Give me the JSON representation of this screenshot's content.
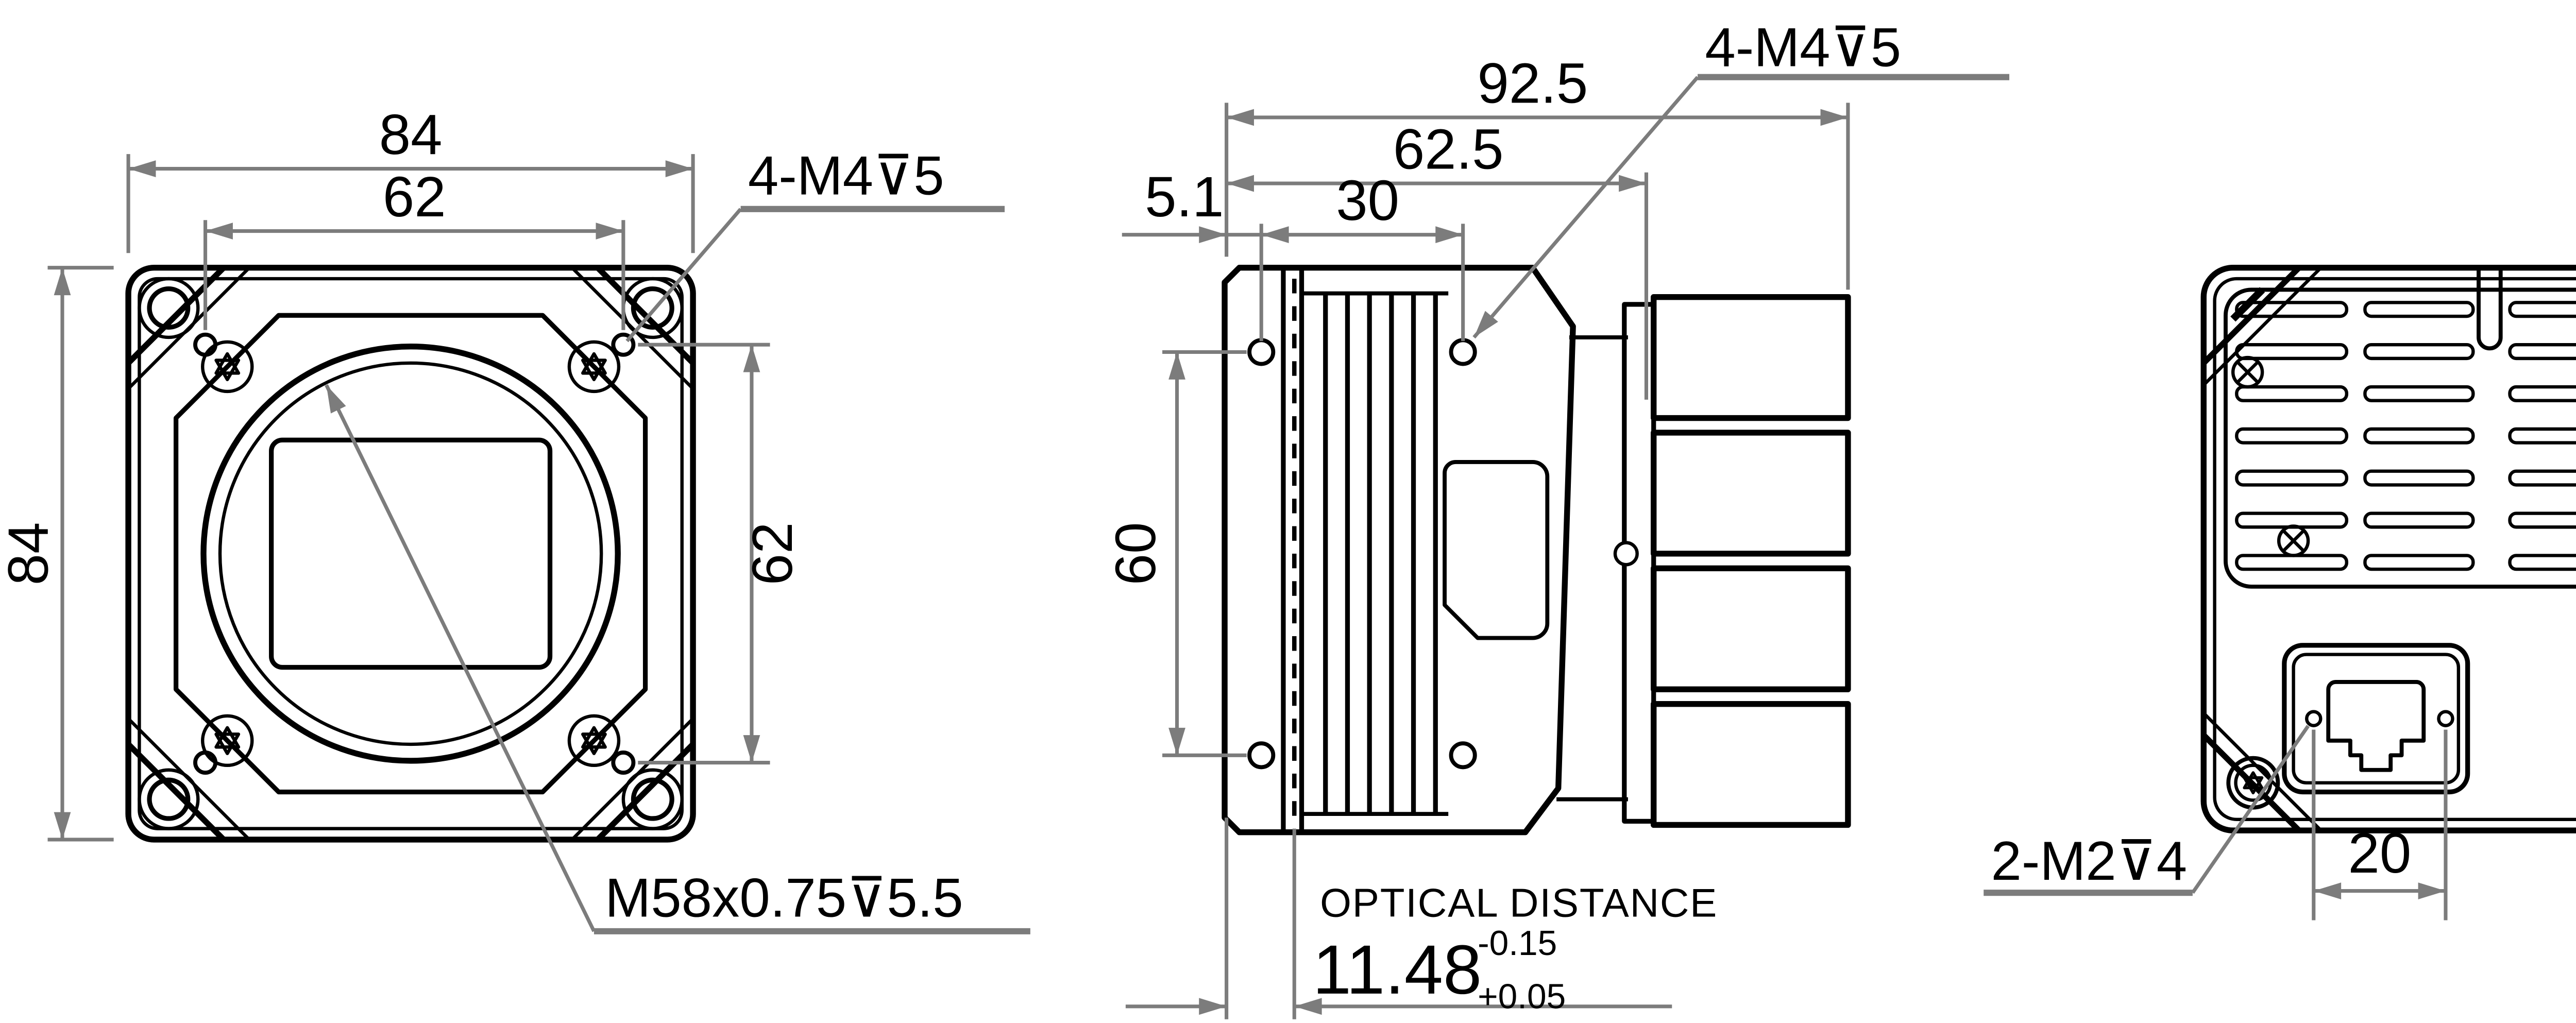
{
  "unit_label": "Unit: mm",
  "front_view": {
    "dim_width": "84",
    "dim_width_inner": "62",
    "dim_height": "84",
    "dim_height_inner": "62",
    "thread_label": "4-M4⊽5",
    "mount_label": "M58x0.75⊽5.5"
  },
  "side_view": {
    "dim_total": "92.5",
    "dim_body": "62.5",
    "dim_flange": "5.1",
    "dim_hole_offset": "30",
    "dim_hole_spacing": "60",
    "thread_label": "4-M4⊽5",
    "optical_distance_label": "OPTICAL DISTANCE",
    "optical_distance_value": "11.48",
    "tolerance_upper": "-0.15",
    "tolerance_lower": "+0.05"
  },
  "rear_view": {
    "thread_label": "2-M2⊽4",
    "dim_hole_spacing": "20"
  },
  "colors": {
    "line": "#000000",
    "dimension": "#7c7c7c",
    "background": "#ffffff"
  }
}
